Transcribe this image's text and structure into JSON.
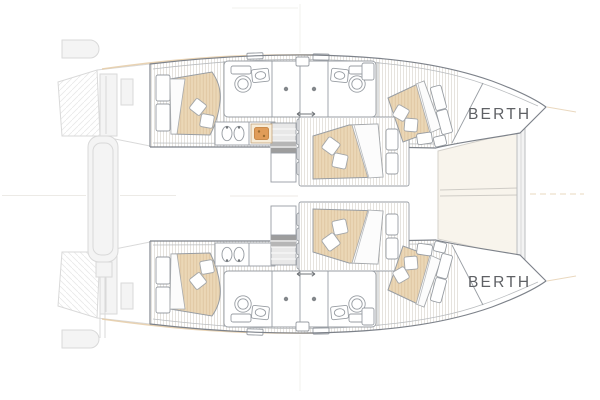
{
  "diagram": {
    "figure": "catamaran-floor-plan",
    "labels": {
      "berth_upper": "BERTH",
      "berth_lower": "BERTH"
    },
    "colors": {
      "background": "#ffffff",
      "outline": "#7d828a",
      "furniture": "#989da3",
      "faint": "#d9d9d9",
      "floor_stripe": "#dedad3",
      "bed": "#ebd7b6",
      "bed_stripe": "#dcc29c",
      "stove": "#e09c58",
      "accent": "#e5cba6",
      "tramp": "#f8f4ec",
      "text": "#5f6165"
    }
  }
}
